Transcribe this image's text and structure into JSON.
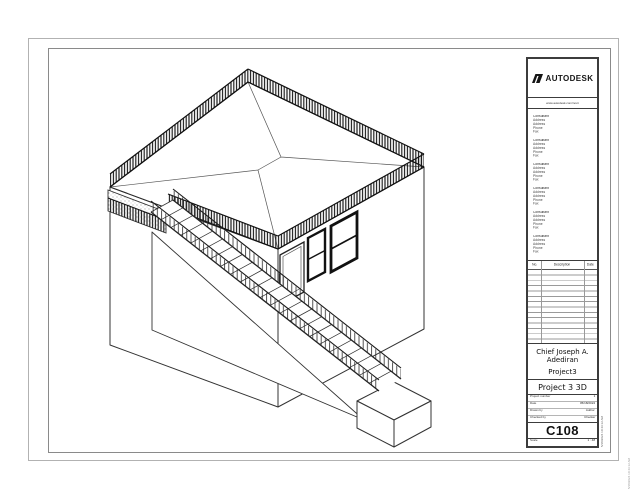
{
  "titleblock": {
    "brand": "AUTODESK",
    "website": "www.autodesk.com/revit",
    "consultants": [
      {
        "lines": [
          "Consultant",
          "Address",
          "Address",
          "Phone",
          "Fax"
        ]
      },
      {
        "lines": [
          "Consultant",
          "Address",
          "Address",
          "Phone",
          "Fax"
        ]
      },
      {
        "lines": [
          "Consultant",
          "Address",
          "Address",
          "Phone",
          "Fax"
        ]
      },
      {
        "lines": [
          "Consultant",
          "Address",
          "Address",
          "Phone",
          "Fax"
        ]
      },
      {
        "lines": [
          "Consultant",
          "Address",
          "Address",
          "Phone",
          "Fax"
        ]
      },
      {
        "lines": [
          "Consultant",
          "Address",
          "Address",
          "Phone",
          "Fax"
        ]
      }
    ],
    "revisions": {
      "no": "No.",
      "description": "Description",
      "date": "Date"
    },
    "client_line1": "Chief Joseph A.",
    "client_line2": "Adediran",
    "project_name": "Project3",
    "sheet_title": "Project 3 3D",
    "fields": [
      {
        "label": "Project number",
        "value": "1"
      },
      {
        "label": "Date",
        "value": "05/18/2024"
      },
      {
        "label": "Drawn by",
        "value": "Author"
      },
      {
        "label": "Checked by",
        "value": "Checker"
      }
    ],
    "sheet_number": "C108",
    "scale_label": "Scale",
    "scale_value": "1 : 48"
  },
  "stamps": {
    "inner": "5/18/2024 10:43:12 AM",
    "edge": "5/18/2024 10:43:12 AM"
  },
  "colors": {
    "line": "#333333",
    "railing": "#161616",
    "titleblock_border": "#3c3c3c",
    "border_outer": "#b2b2b2",
    "border_inner": "#8a8a8a"
  }
}
